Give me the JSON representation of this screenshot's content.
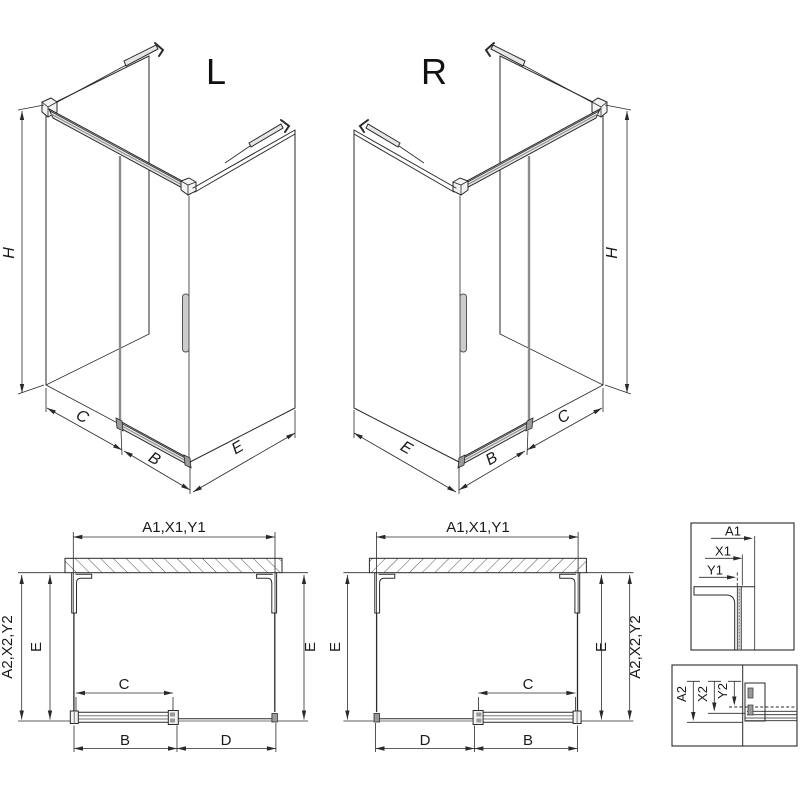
{
  "drawing": {
    "iso_left": {
      "variant_label": "L",
      "dim_height": "H",
      "dim_opening": "C",
      "dim_door": "B",
      "dim_depth": "E"
    },
    "iso_right": {
      "variant_label": "R",
      "dim_height": "H",
      "dim_opening": "C",
      "dim_door": "B",
      "dim_depth": "E"
    },
    "plan_left": {
      "dim_top": "A1,X1,Y1",
      "dim_outer_side": "A2,X2,Y2",
      "dim_depth_left": "E",
      "dim_depth_right": "E",
      "dim_opening": "C",
      "dim_door": "B",
      "dim_fixed": "D"
    },
    "plan_right": {
      "dim_top": "A1,X1,Y1",
      "dim_outer_side": "A2,X2,Y2",
      "dim_depth_left": "E",
      "dim_depth_right": "E",
      "dim_opening": "C",
      "dim_door": "B",
      "dim_fixed": "D"
    },
    "detail_top": {
      "dim_a": "A1",
      "dim_x": "X1",
      "dim_y": "Y1"
    },
    "detail_bottom": {
      "dim_a": "A2",
      "dim_x": "X2",
      "dim_y": "Y2"
    },
    "colors": {
      "line": "#2a2a2a",
      "secondary": "#8c8c8c",
      "fill_light": "#e6e6e6",
      "background": "#ffffff"
    }
  }
}
